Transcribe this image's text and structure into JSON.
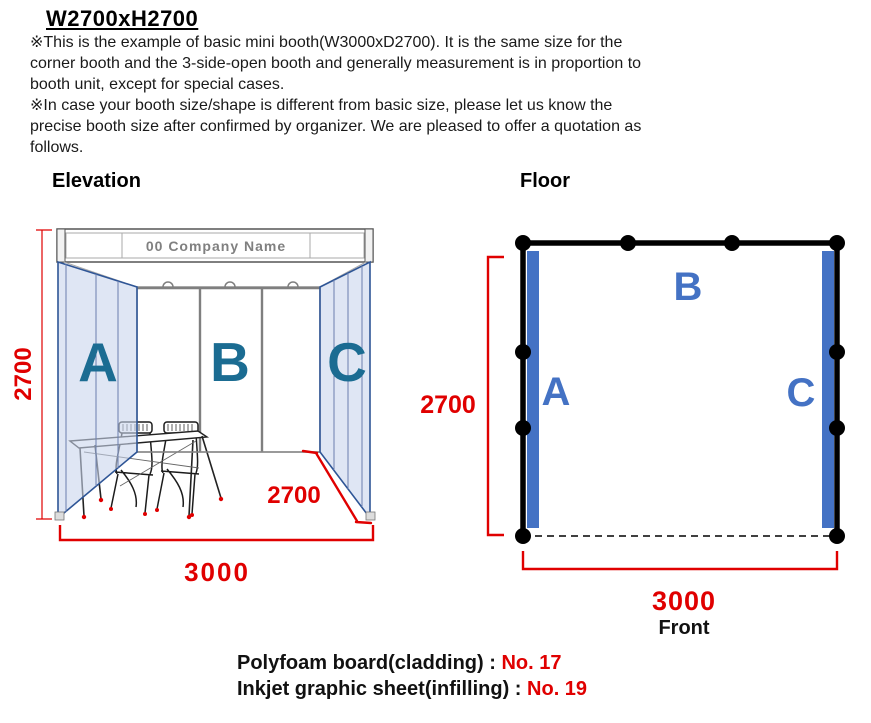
{
  "colors": {
    "red": "#e00000",
    "plan_blue": "#4472c4",
    "elev_letter": "#1b6c92",
    "wall_fill": "#c9d6ed",
    "wall_border": "#2e5596"
  },
  "header": {
    "title": "W2700xH2700",
    "notes": [
      "※This is the example of basic mini booth(W3000xD2700). It is the same size for the",
      "corner booth and the 3-side-open booth and generally measurement is in proportion to",
      "booth unit, except for special cases.",
      "※In case your booth size/shape is different from basic size, please let us know the",
      "precise booth size after confirmed by organizer. We are pleased to offer a quotation as",
      "follows."
    ]
  },
  "elevation": {
    "label": "Elevation",
    "fascia_text": "00 Company Name",
    "letter_a": "A",
    "letter_b": "B",
    "letter_c": "C",
    "dim_height": "2700",
    "dim_depth": "2700",
    "dim_width": "3000"
  },
  "floor": {
    "label": "Floor",
    "letter_a": "A",
    "letter_b": "B",
    "letter_c": "C",
    "dim_depth": "2700",
    "dim_width": "3000",
    "front_label": "Front"
  },
  "footer": {
    "line1_label": "Polyfoam board(cladding) : ",
    "line1_value": "No. 17",
    "line2_label": "Inkjet graphic sheet(infilling) : ",
    "line2_value": "No. 19"
  }
}
